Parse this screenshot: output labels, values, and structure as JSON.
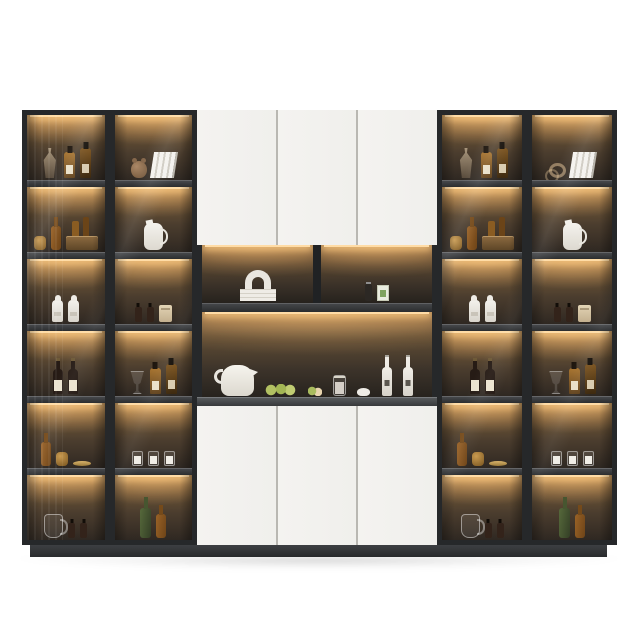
{
  "meta": {
    "description": "Modern wall-unit bar display cabinet: four LED-lit glass bottle columns flanking a white cabinet with open shelves, kettle and wine display",
    "background": "#ffffff"
  },
  "palette": {
    "frame": "#26282a",
    "shelf": "#3e4042",
    "led_glow": "#ffdca6",
    "wood_back_top": "#97744a",
    "wood_back_bottom": "#2f2822",
    "door_white": "#f2f1ee",
    "counter": "#5b5e61",
    "plinth": "#37393c"
  },
  "left_columns": [
    {
      "name": "glass-column-1",
      "shelves": [
        {
          "label": "decanter-and-whisky",
          "items": [
            "decanter",
            "whisky-bottle",
            "whisky-bottle-tall"
          ]
        },
        {
          "label": "gold-basket-still-life",
          "items": [
            "amber-jar",
            "amber-bottle",
            "crate-of-bottles"
          ]
        },
        {
          "label": "white-bottles",
          "items": [
            "white-bottle",
            "white-bottle"
          ]
        },
        {
          "label": "red-wine-bottles",
          "items": [
            "red-wine-bottle",
            "red-wine-bottle"
          ]
        },
        {
          "label": "amber-bottles-and-tray",
          "items": [
            "amber-bottle",
            "amber-jar",
            "gold-tray"
          ]
        },
        {
          "label": "pitcher-and-oil-bottles",
          "items": [
            "glass-pitcher",
            "oil-bottle",
            "oil-bottle"
          ]
        }
      ]
    },
    {
      "name": "glass-column-2",
      "shelves": [
        {
          "label": "decor-and-books",
          "items": [
            "bear-sculpture",
            "leaning-books"
          ]
        },
        {
          "label": "white-jug",
          "items": [
            "white-jug"
          ]
        },
        {
          "label": "condiments-and-paper-bag",
          "items": [
            "oil-bottle",
            "oil-bottle",
            "paper-bag"
          ]
        },
        {
          "label": "goblet-and-whisky",
          "items": [
            "goblet",
            "whisky-bottle",
            "whisky-bottle-tall"
          ]
        },
        {
          "label": "candle-jars",
          "items": [
            "candle-jar",
            "candle-jar",
            "candle-jar"
          ]
        },
        {
          "label": "green-and-amber-bottle",
          "items": [
            "green-bottle",
            "amber-bottle"
          ]
        }
      ]
    }
  ],
  "right_columns": [
    {
      "name": "glass-column-3",
      "shelves": [
        {
          "label": "decanter-and-whisky",
          "items": [
            "decanter",
            "whisky-bottle",
            "whisky-bottle-tall"
          ]
        },
        {
          "label": "gold-basket-still-life",
          "items": [
            "amber-jar",
            "amber-bottle",
            "crate-of-bottles"
          ]
        },
        {
          "label": "white-bottles",
          "items": [
            "white-bottle",
            "white-bottle"
          ]
        },
        {
          "label": "red-wine-bottles",
          "items": [
            "red-wine-bottle",
            "red-wine-bottle"
          ]
        },
        {
          "label": "amber-bottles-and-tray",
          "items": [
            "amber-bottle",
            "amber-jar",
            "gold-tray"
          ]
        },
        {
          "label": "pitcher-and-oil-bottles",
          "items": [
            "glass-pitcher",
            "oil-bottle",
            "oil-bottle"
          ]
        }
      ]
    },
    {
      "name": "glass-column-4",
      "shelves": [
        {
          "label": "glass-decor-and-books",
          "items": [
            "glass-rings",
            "leaning-books"
          ]
        },
        {
          "label": "white-jug",
          "items": [
            "white-jug"
          ]
        },
        {
          "label": "condiments-and-paper-bag",
          "items": [
            "oil-bottle",
            "oil-bottle",
            "paper-bag"
          ]
        },
        {
          "label": "goblet-and-whisky",
          "items": [
            "goblet",
            "whisky-bottle",
            "whisky-bottle-tall"
          ]
        },
        {
          "label": "candle-jars",
          "items": [
            "candle-jar",
            "candle-jar",
            "candle-jar"
          ]
        },
        {
          "label": "green-and-amber-bottle",
          "items": [
            "green-bottle",
            "amber-bottle"
          ]
        }
      ]
    }
  ],
  "center": {
    "top_doors": [
      "upper-door-1",
      "upper-door-2",
      "upper-door-3"
    ],
    "bottom_doors": [
      "lower-door-1",
      "lower-door-2",
      "lower-door-3"
    ],
    "niche_top_left": {
      "label": "arch-sculpture-on-books",
      "items": [
        "arch-on-books"
      ]
    },
    "niche_top_right": {
      "label": "grinder-and-tea-box",
      "items": [
        "pepper-grinder",
        "tea-box"
      ]
    },
    "counter_display": {
      "label": "kettle-fruit-carafe-and-wine",
      "items": [
        "kettle",
        "fruit-group",
        "fruit-slice",
        "carafe",
        "garlic-bowl",
        "white-wine-bottle",
        "white-wine-bottle"
      ]
    }
  }
}
